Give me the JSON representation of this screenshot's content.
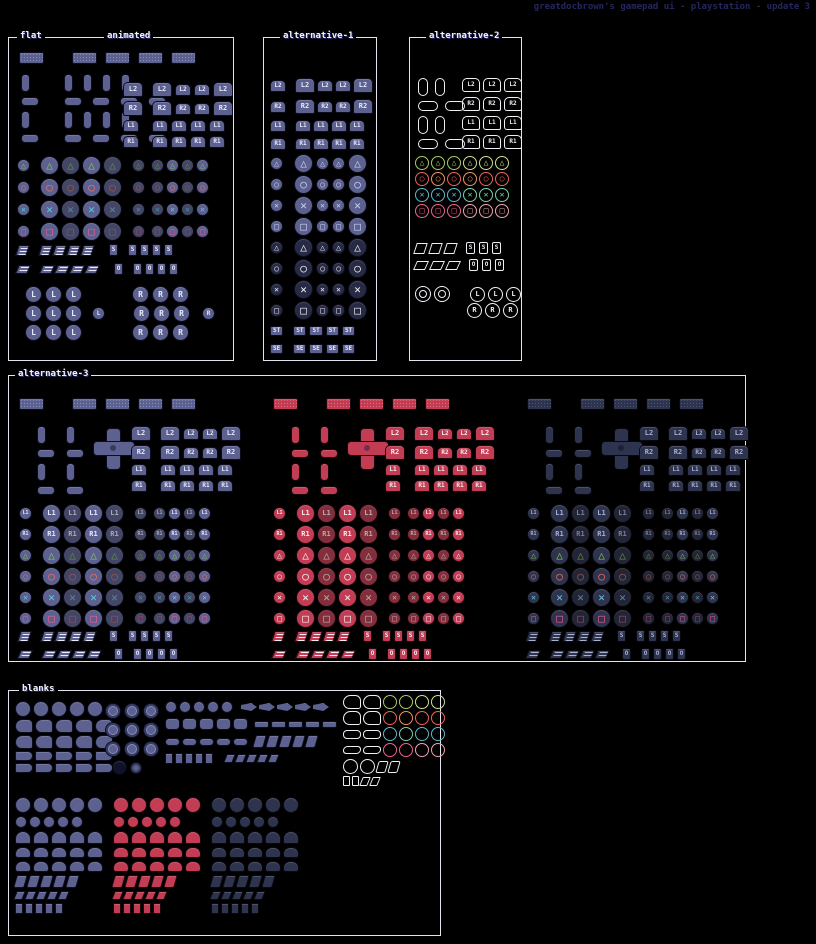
{
  "title": "greatdocbrown's gamepad ui - playstation - update 3",
  "palette": {
    "background": "#000000",
    "title_text": "#26265e",
    "section_border": "#e4e4f0",
    "section_label_text": "#f2f2fa",
    "blue_base": "#5c6190",
    "blue_light": "#858cbb",
    "blue_dark": "#343a62",
    "red_base": "#c23d53",
    "red_dark": "#7c2950",
    "navy_base": "#2f344e",
    "glyph_triangle": "#84c653",
    "glyph_circle": "#f2705c",
    "glyph_cross": "#66c6dc",
    "glyph_square": "#f25c90",
    "outline_white": "#eef0f4",
    "outline_green": "#a9cc62",
    "outline_orange": "#f2945a",
    "outline_red": "#f2625c",
    "outline_teal": "#5cb8cc",
    "outline_pink": "#f2628e"
  },
  "glyphs": {
    "tri": "△",
    "cir": "○",
    "cro": "✕",
    "squ": "□"
  },
  "sections": [
    {
      "id": "flat-animated",
      "x": 8,
      "y": 37,
      "w": 226,
      "h": 324,
      "theme": "theme-blue",
      "labels": [
        {
          "text": "flat",
          "x": 8
        },
        {
          "text": "animated",
          "x": 95
        }
      ],
      "clusters": [
        {
          "name": "touchpad-row",
          "x": 10,
          "y": 14,
          "cg": 8,
          "rg": 2,
          "rows": [
            "tp gap:12 tp tp tp tp"
          ]
        },
        {
          "name": "stick-pads",
          "x": 12,
          "y": 36,
          "cg": 10,
          "rg": 5,
          "rows": [
            "padv gap:14 padv padv padv padv",
            "padh gap:5 padh padh padh padh",
            "padv gap:14 padv padv padv padv",
            "padh gap:5 padh padh padh padh"
          ]
        },
        {
          "name": "shoulder-buttons",
          "x": 114,
          "y": 44,
          "cg": 3,
          "rg": 4,
          "rows": [
            "sh:L2:lg gap:3 sh:L2:lg sh:L2:sm sh:L2:sm sh:L2:lg",
            "sh:R2:lg gap:3 sh:R2:lg sh:R2:sm sh:R2:sm sh:R2:lg",
            "sh:L1:sm gap:7 sh:L1:sm sh:L1:sm sh:L1:sm sh:L1:sm",
            "sh:R1:sm gap:7 sh:R1:sm sh:R1:sm sh:R1:sm sh:R1:sm"
          ]
        },
        {
          "name": "face-buttons",
          "x": 8,
          "y": 118,
          "cg": 2,
          "rg": 3,
          "dim": true,
          "rows": [
            "face:tri:sm gap:6 face:tri:lg face:tri:lg face:tri:lg face:tri:lg gap:6 face:tri:sm gap:2 face:tri:sm face:tri:sm face:tri:sm face:tri:sm",
            "face:cir:sm gap:6 face:cir:lg face:cir:lg face:cir:lg face:cir:lg gap:6 face:cir:sm gap:2 face:cir:sm face:cir:sm face:cir:sm face:cir:sm",
            "face:cro:sm gap:6 face:cro:lg face:cro:lg face:cro:lg face:cro:lg gap:6 face:cro:sm gap:2 face:cro:sm face:cro:sm face:cro:sm face:cro:sm",
            "face:squ:sm gap:6 face:squ:lg face:squ:lg face:squ:lg face:squ:lg gap:6 face:squ:sm gap:2 face:squ:sm face:squ:sm face:squ:sm face:squ:sm"
          ]
        },
        {
          "name": "start-select",
          "x": 8,
          "y": 206,
          "cg": 3,
          "rg": 7,
          "rows": [
            "st gap:6 st st st st gap:10 sq:S gap:4 sq:S sq:S sq:S sq:S",
            "sel gap:6 sel sel sel sel gap:10 sq:O gap:4 sq:O sq:O sq:O sq:O"
          ]
        },
        {
          "name": "stick-press-grids",
          "x": 16,
          "y": 248,
          "cg": 3,
          "rg": 2,
          "rows": [
            "stick:L:lg stick:L:lg stick:L:lg gap:44 stick:R:lg stick:R:lg stick:R:lg",
            "stick:L:lg stick:L:lg stick:L:lg gap:4 stick:L:sm gap:22 stick:R:lg stick:R:lg stick:R:lg gap:6 stick:R:sm",
            "stick:L:lg stick:L:lg stick:L:lg gap:44 stick:R:lg stick:R:lg stick:R:lg"
          ]
        }
      ]
    },
    {
      "id": "alternative-1",
      "x": 263,
      "y": 37,
      "w": 114,
      "h": 324,
      "theme": "theme-blue",
      "labels": [
        {
          "text": "alternative-1",
          "x": 16
        }
      ],
      "clusters": [
        {
          "name": "shoulder-buttons",
          "x": 6,
          "y": 40,
          "cg": 2,
          "rg": 6,
          "rows": [
            "sh:L2:sm gap:5 sh:L2:lg sh:L2:sm sh:L2:sm sh:L2:lg",
            "sh:R2:sm gap:5 sh:R2:lg sh:R2:sm sh:R2:sm sh:R2:lg",
            "sh:L1:sm gap:5 sh:L1:sm sh:L1:sm sh:L1:sm sh:L1:sm",
            "sh:R1:sm gap:5 sh:R1:sm sh:R1:sm sh:R1:sm sh:R1:sm"
          ]
        },
        {
          "name": "face-buttons-mono",
          "x": 6,
          "y": 116,
          "cg": 3,
          "rg": 2,
          "rows": [
            "face:tri:sm:mono gap:5 face:tri:lg:mono face:tri:sm:mono face:tri:sm:mono face:tri:lg:mono",
            "face:cir:sm:mono gap:5 face:cir:lg:mono face:cir:sm:mono face:cir:sm:mono face:cir:lg:mono",
            "face:cro:sm:mono gap:5 face:cro:lg:mono face:cro:sm:mono face:cro:sm:mono face:cro:lg:mono",
            "face:squ:sm:mono gap:5 face:squ:lg:mono face:squ:sm:mono face:squ:sm:mono face:squ:lg:mono"
          ]
        },
        {
          "name": "face-buttons-dark",
          "x": 6,
          "y": 200,
          "cg": 3,
          "rg": 2,
          "rows": [
            "face2:tri:sm:w gap:5 face2:tri:lg:w face2:tri:sm:w face2:tri:sm:w face2:tri:lg:w",
            "face2:cir:sm:w gap:5 face2:cir:lg:w face2:cir:sm:w face2:cir:sm:w face2:cir:lg:w",
            "face2:cro:sm:w gap:5 face2:cro:lg:w face2:cro:sm:w face2:cro:sm:w face2:cro:lg:w",
            "face2:squ:sm:w gap:5 face2:squ:lg:w face2:squ:sm:w face2:squ:sm:w face2:squ:lg:w"
          ]
        },
        {
          "name": "start-select-labels",
          "x": 6,
          "y": 288,
          "cg": 3,
          "rg": 8,
          "rows": [
            "lbl:ST gap:4 lbl:ST lbl:ST lbl:ST lbl:ST",
            "lbl:SE gap:4 lbl:SE lbl:SE lbl:SE lbl:SE"
          ]
        }
      ]
    },
    {
      "id": "alternative-2",
      "x": 409,
      "y": 37,
      "w": 113,
      "h": 324,
      "theme": "theme-blue",
      "labels": [
        {
          "text": "alternative-2",
          "x": 16
        }
      ],
      "clusters": [
        {
          "name": "outline-stick-pads",
          "x": 8,
          "y": 40,
          "cg": 7,
          "rg": 5,
          "rows": [
            "o-padv o-padv",
            "o-padh o-padh",
            "o-padv o-padv",
            "o-padh o-padh"
          ]
        },
        {
          "name": "outline-shoulders",
          "x": 52,
          "y": 40,
          "cg": 3,
          "rg": 5,
          "rows": [
            "o-sh:L2 o-sh:L2 o-sh:L2",
            "o-sh:R2 o-sh:R2 o-sh:R2",
            "o-sh:L1 o-sh:L1 o-sh:L1",
            "o-sh:R1 o-sh:R1 o-sh:R1"
          ]
        },
        {
          "name": "outline-face-buttons",
          "x": 5,
          "y": 118,
          "cg": 2,
          "rg": 2,
          "rows": [
            "o-face:tri:g1 o-face:tri:g1 o-face:tri:g1 o-face:tri:g2 o-face:tri:g2 o-face:tri:g2",
            "o-face:cir:r1 o-face:cir:r2 o-face:cir:r1 o-face:cir:r2 o-face:cir:r1 o-face:cir:r1",
            "o-face:cro:t1 o-face:cro:t1 o-face:cro:t1 o-face:cro:t2 o-face:cro:t2 o-face:cro:t2",
            "o-face:squ:p1 o-face:squ:p1 o-face:squ:p1 o-face:squ:p2 o-face:squ:p2 o-face:squ:p2"
          ]
        },
        {
          "name": "outline-start-select",
          "x": 5,
          "y": 204,
          "cg": 4,
          "rg": 5,
          "rows": [
            "o-st o-st o-st gap:2 o-sq:S o-sq:S o-sq:S",
            "o-sel o-sel o-sel gap:2 o-sq:O o-sq:O o-sq:O"
          ]
        },
        {
          "name": "outline-rings-sticks",
          "x": 5,
          "y": 248,
          "cg": 3,
          "rg": 1,
          "rows": [
            "o-ring o-ring gap:14 o-stick:L o-stick:L o-stick:L",
            "gap:49 o-stick:R o-stick:R o-stick:R"
          ]
        }
      ]
    },
    {
      "id": "alternative-3",
      "x": 8,
      "y": 375,
      "w": 738,
      "h": 287,
      "theme": "theme-blue",
      "labels": [
        {
          "text": "alternative-3",
          "x": 6
        }
      ],
      "groups": [
        {
          "x": 6,
          "theme": "theme-blue",
          "glyph": ""
        },
        {
          "x": 260,
          "theme": "theme-red",
          "glyph": ":w"
        },
        {
          "x": 514,
          "theme": "theme-navy",
          "glyph": ""
        }
      ],
      "template": [
        {
          "name": "touchpad-row",
          "x": 4,
          "y": 22,
          "cg": 8,
          "rg": 2,
          "rows": [
            "tp gap:12 tp tp tp tp"
          ]
        },
        {
          "name": "dpad-pieces",
          "x": 22,
          "y": 50,
          "cg": 4,
          "rg": 5,
          "rows": [
            "padv gap:12 padv",
            "padh gap:3 padh",
            "padv gap:12 padv",
            "padh gap:3 padh"
          ]
        },
        {
          "name": "dpad-cross",
          "x": 78,
          "y": 52,
          "cg": 2,
          "rg": 2,
          "rows": [
            "dpad"
          ]
        },
        {
          "name": "shoulder-buttons",
          "x": 116,
          "y": 50,
          "cg": 3,
          "rg": 4,
          "rows": [
            "sh:L2:lg gap:3 sh:L2:lg sh:L2:sm sh:L2:sm sh:L2:lg",
            "sh:R2:lg gap:3 sh:R2:lg sh:R2:sm sh:R2:sm sh:R2:lg",
            "sh:L1:sm gap:7 sh:L1:sm sh:L1:sm sh:L1:sm sh:L1:sm",
            "sh:R1:sm gap:7 sh:R1:sm sh:R1:sm sh:R1:sm sh:R1:sm"
          ]
        },
        {
          "name": "face-buttons",
          "x": 4,
          "y": 128,
          "cg": 2,
          "rg": 2,
          "dim": true,
          "rows": [
            "cbtn:L1:sm gap:6 cbtn:L1:lg cbtn:L1:lg cbtn:L1:lg cbtn:L1:lg gap:6 cbtn:L1:sm gap:2 cbtn:L1:sm cbtn:L1:sm cbtn:L1:sm cbtn:L1:sm",
            "cbtn:R1:sm gap:6 cbtn:R1:lg cbtn:R1:lg cbtn:R1:lg cbtn:R1:lg gap:6 cbtn:R1:sm gap:2 cbtn:R1:sm cbtn:R1:sm cbtn:R1:sm cbtn:R1:sm",
            "face:tri:sm%G gap:6 face:tri:lg%G face:tri:lg%G face:tri:lg%G face:tri:lg%G gap:6 face:tri:sm%G gap:2 face:tri:sm%G face:tri:sm%G face:tri:sm%G face:tri:sm%G",
            "face:cir:sm%G gap:6 face:cir:lg%G face:cir:lg%G face:cir:lg%G face:cir:lg%G gap:6 face:cir:sm%G gap:2 face:cir:sm%G face:cir:sm%G face:cir:sm%G face:cir:sm%G",
            "face:cro:sm%G gap:6 face:cro:lg%G face:cro:lg%G face:cro:lg%G face:cro:lg%G gap:6 face:cro:sm%G gap:2 face:cro:sm%G face:cro:sm%G face:cro:sm%G face:cro:sm%G",
            "face:squ:sm%G gap:6 face:squ:lg%G face:squ:lg%G face:squ:lg%G face:squ:lg%G gap:6 face:squ:sm%G gap:2 face:squ:sm%G face:squ:sm%G face:squ:sm%G face:squ:sm%G"
          ]
        },
        {
          "name": "start-select",
          "x": 4,
          "y": 254,
          "cg": 3,
          "rg": 6,
          "rows": [
            "st gap:6 st st st st gap:8 sq:S gap:4 sq:S sq:S sq:S sq:S",
            "sel gap:6 sel sel sel sel gap:8 sq:O gap:4 sq:O sq:O sq:O sq:O"
          ]
        }
      ]
    },
    {
      "id": "blanks",
      "x": 8,
      "y": 690,
      "w": 433,
      "h": 246,
      "theme": "theme-blue",
      "labels": [
        {
          "text": "blanks",
          "x": 10
        }
      ],
      "clusters": [
        {
          "name": "blank-circles-wedges",
          "x": 6,
          "y": 10,
          "cg": 2,
          "rg": 2,
          "rows": [
            "bl-circle*5",
            "bl-wedge*5",
            "bl-wedge*5",
            "bl-wedgef*5",
            "bl-wedgef*5"
          ]
        },
        {
          "name": "blank-ring-grid",
          "x": 96,
          "y": 12,
          "cg": 3,
          "rg": 3,
          "rows": [
            "bl-ring*3",
            "bl-ring*3",
            "bl-ring*3",
            "gap:4 bl-dark bl-ringsm"
          ]
        },
        {
          "name": "blank-bars-chevrons",
          "x": 156,
          "y": 10,
          "cg": 2,
          "rg": 5,
          "rows": [
            "bl-circsm*5 gap:4 bl-arrow*5",
            "bl-blob*5 gap:2 bl-bar*5",
            "bl-caps*5 gap:2 bl-slant*5",
            "bl-rectsm*5 gap:8 bl-slantsm*5"
          ]
        },
        {
          "name": "blank-outline-shapes",
          "x": 334,
          "y": 4,
          "cg": 2,
          "rg": 2,
          "rows": [
            "o-wedge o-wedge o-circ:g1 o-circ:g1 o-circ:g2 o-circ:g2",
            "o-wedge o-wedge o-circ:r1 o-circ:r2 o-circ:r1 o-circ:r1",
            "o-caps o-caps o-circ:t1 o-circ:t2 o-circ:t1 o-circ:t1",
            "o-caps2 o-caps2 o-circ:p1 o-circ:p1 o-circ:p2 o-circ:p2",
            "o-circle o-circle o-slant o-slant",
            "o-rectsm o-rectsm o-slantsm o-slantsm"
          ]
        },
        {
          "name": "blank-grid-blue",
          "x": 6,
          "y": 106,
          "theme": "theme-blue",
          "cg": 2,
          "rg": 3,
          "rows": [
            "bl-circle*5",
            "bl-circsm*5",
            "bl-arch*5",
            "bl-half*5",
            "bl-half*5",
            "bl-slant*5",
            "bl-slantsm*5",
            "bl-rectsm*5"
          ]
        },
        {
          "name": "blank-grid-red",
          "x": 104,
          "y": 106,
          "theme": "theme-red",
          "cg": 2,
          "rg": 3,
          "rows": [
            "bl-circle*5",
            "bl-circsm*5",
            "bl-arch*5",
            "bl-half*5",
            "bl-half*5",
            "bl-slant*5",
            "bl-slantsm*5",
            "bl-rectsm*5"
          ]
        },
        {
          "name": "blank-grid-navy",
          "x": 202,
          "y": 106,
          "theme": "theme-navy",
          "cg": 2,
          "rg": 3,
          "rows": [
            "bl-circle*5",
            "bl-circsm*5",
            "bl-arch*5",
            "bl-half*5",
            "bl-half*5",
            "bl-slant*5",
            "bl-slantsm*5",
            "bl-rectsm*5"
          ]
        }
      ]
    }
  ]
}
